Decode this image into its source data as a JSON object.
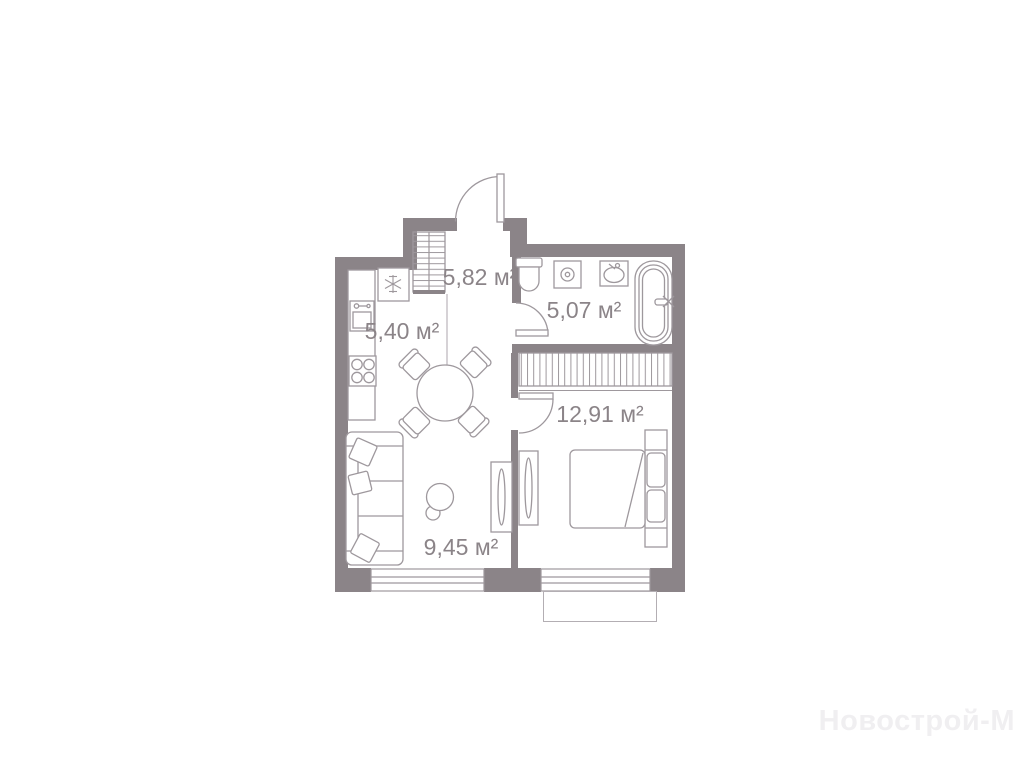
{
  "plan": {
    "type": "apartment-floor-plan",
    "wall_color": "#8b8488",
    "fixture_line_color": "#9e989d",
    "label_color": "#8b8488",
    "rooms": [
      {
        "id": "hallway",
        "area_label": "5,82 м²"
      },
      {
        "id": "kitchen",
        "area_label": "5,40 м²"
      },
      {
        "id": "bathroom",
        "area_label": "5,07 м²"
      },
      {
        "id": "bedroom",
        "area_label": "12,91 м²"
      },
      {
        "id": "living-room",
        "area_label": "9,45 м²"
      }
    ],
    "fixtures": [
      "entrance-door",
      "hall-wardrobe",
      "fridge",
      "kitchen-sink",
      "stove",
      "dining-table",
      "chair",
      "sofa",
      "pillow",
      "floor-lamp",
      "tv-unit",
      "toilet",
      "washing-machine",
      "bathroom-sink",
      "bathtub",
      "bathroom-door",
      "bedroom-door",
      "bedroom-wardrobe",
      "bed",
      "nightstand",
      "window",
      "balcony"
    ]
  },
  "watermark": {
    "text": "Новострой-М",
    "color": "#f0eff1"
  }
}
